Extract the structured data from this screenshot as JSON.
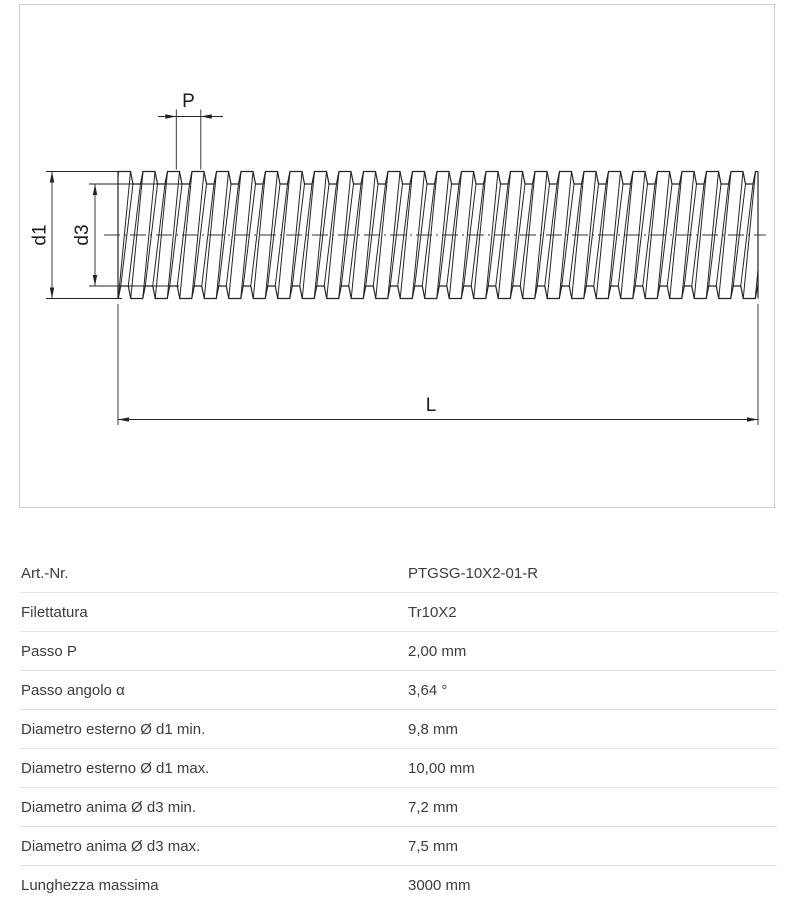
{
  "drawing": {
    "border_color": "#cccccc",
    "line_color": "#232323",
    "labels": {
      "pitch": "P",
      "outer_diameter": "d1",
      "core_diameter": "d3",
      "length": "L"
    }
  },
  "table": {
    "rows": [
      {
        "label": "Art.-Nr.",
        "value": "PTGSG-10X2-01-R"
      },
      {
        "label": "Filettatura",
        "value": "Tr10X2"
      },
      {
        "label": "Passo P",
        "value": "2,00 mm"
      },
      {
        "label": "Passo angolo α",
        "value": "3,64 °"
      },
      {
        "label": "Diametro esterno Ø d1 min.",
        "value": "9,8 mm"
      },
      {
        "label": "Diametro esterno Ø d1 max.",
        "value": "10,00 mm"
      },
      {
        "label": "Diametro anima Ø d3 min.",
        "value": "7,2 mm"
      },
      {
        "label": "Diametro anima Ø d3 max.",
        "value": "7,5 mm"
      },
      {
        "label": "Lunghezza massima",
        "value": "3000 mm"
      }
    ]
  }
}
